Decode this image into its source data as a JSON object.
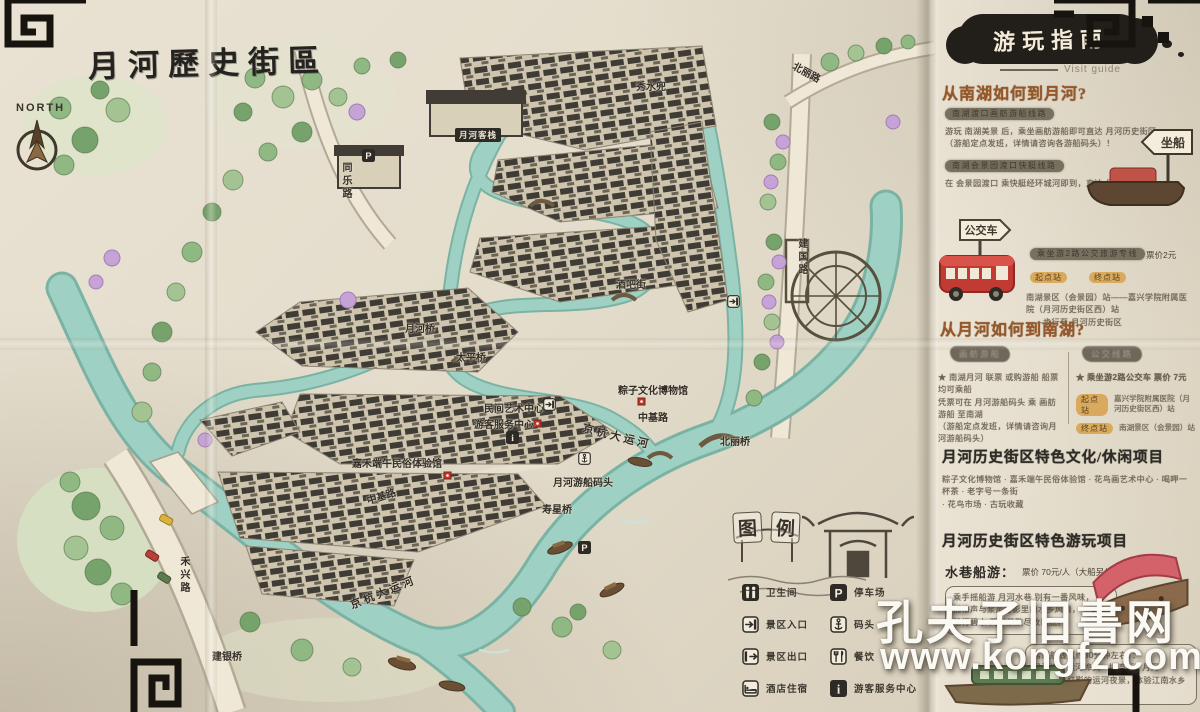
{
  "map": {
    "title": "月河歷史街區",
    "north_label": "NORTH",
    "labels": [
      {
        "text": "月河客栈",
        "x": 455,
        "y": 128,
        "cls": "sign"
      },
      {
        "text": "秀水兜",
        "x": 636,
        "y": 78
      },
      {
        "text": "北丽路",
        "x": 792,
        "y": 64,
        "r": 28
      },
      {
        "text": "同乐路",
        "x": 338,
        "y": 162,
        "v": 1
      },
      {
        "text": "建国路",
        "x": 794,
        "y": 238,
        "v": 1
      },
      {
        "text": "酒吧街",
        "x": 616,
        "y": 276
      },
      {
        "text": "月河桥",
        "x": 405,
        "y": 320
      },
      {
        "text": "太平桥",
        "x": 456,
        "y": 349
      },
      {
        "text": "粽子文化博物馆",
        "x": 618,
        "y": 382
      },
      {
        "text": "中基路",
        "x": 638,
        "y": 409
      },
      {
        "text": "民间艺术中心",
        "x": 484,
        "y": 400
      },
      {
        "text": "游客服务中心",
        "x": 474,
        "y": 416
      },
      {
        "text": "嘉禾端午民俗体验馆",
        "x": 352,
        "y": 455
      },
      {
        "text": "中基路",
        "x": 366,
        "y": 488,
        "r": -18
      },
      {
        "text": "月河游船码头",
        "x": 553,
        "y": 474
      },
      {
        "text": "京杭大运河",
        "x": 582,
        "y": 428,
        "r": 14,
        "cls": "big"
      },
      {
        "text": "北丽桥",
        "x": 720,
        "y": 433
      },
      {
        "text": "寿星桥",
        "x": 542,
        "y": 501
      },
      {
        "text": "京杭大运河",
        "x": 348,
        "y": 584,
        "r": -22,
        "cls": "big"
      },
      {
        "text": "禾兴路",
        "x": 176,
        "y": 556,
        "v": 1
      },
      {
        "text": "建银桥",
        "x": 212,
        "y": 648
      }
    ],
    "markers": [
      {
        "icon": "parking",
        "x": 362,
        "y": 149
      },
      {
        "icon": "parking",
        "x": 578,
        "y": 541
      },
      {
        "icon": "info",
        "x": 506,
        "y": 431
      },
      {
        "icon": "anchor",
        "x": 578,
        "y": 452
      },
      {
        "icon": "entrance",
        "x": 727,
        "y": 295
      },
      {
        "icon": "entrance",
        "x": 543,
        "y": 398
      }
    ]
  },
  "legend": {
    "title": "图例",
    "left": [
      {
        "icon": "toilet",
        "label": "卫生间"
      },
      {
        "icon": "entrance",
        "label": "景区入口"
      },
      {
        "icon": "exit",
        "label": "景区出口"
      },
      {
        "icon": "hotel",
        "label": "酒店住宿"
      }
    ],
    "right": [
      {
        "icon": "parking",
        "label": "停车场"
      },
      {
        "icon": "anchor",
        "label": "码头"
      },
      {
        "icon": "dining",
        "label": "餐饮"
      },
      {
        "icon": "info",
        "label": "游客服务中心"
      }
    ]
  },
  "guide": {
    "title": "游玩指南",
    "subtitle": "Visit guide",
    "s1": {
      "title": "从南湖如何到月河?",
      "bar1": "南湖渡口画舫游船线路",
      "p1": [
        "游玩 南湖美景 后，乘坐画舫游船即可直达 月河历史街区",
        "（游船定点发班，详情请咨询各游船码头）！"
      ],
      "bar2": "南湖会景园渡口快艇线路",
      "p2": [
        "在 会景园渡口 乘快艇经环城河即到，直达 月河历史街区"
      ],
      "boat_sign": "坐船"
    },
    "bus": {
      "sign": "公交车",
      "line": "乘坐游2路公交旅游专线",
      "price": "票价2元",
      "start_tag": "起点站",
      "end_tag": "终点站",
      "p": [
        "南湖景区（会景园）站——嘉兴学院附属医院（月河历史街区西）站",
        "——步行至 月河历史街区"
      ]
    },
    "s2": {
      "title": "从月河如何到南湖?",
      "col1_head": "画舫游船",
      "col2_head": "公交线路",
      "col1": [
        "★ 南湖月河 联票 或购游船 船票 均可乘船",
        "凭票可在 月河游船码头 乘 画舫游船 至南湖",
        "（游船定点发班，详情请咨询月河游船码头）"
      ],
      "col2_star": "★ 乘坐游2路公交车  票价 7元",
      "col2_rows": [
        {
          "tag": "起点站",
          "text": "嘉兴学院附属医院（月河历史街区西）站"
        },
        {
          "tag": "终点站",
          "text": "南湖景区（会景园）站"
        }
      ]
    },
    "s3": {
      "title": "月河历史街区特色文化/休闲项目",
      "p": [
        "粽子文化博物馆 · 嘉禾端午民俗体验馆 · 花鸟画艺术中心 · 喝呷一杯茶 · 老字号一条街",
        "· 花鸟市场 · 古玩收藏"
      ]
    },
    "s4": {
      "title": "月河历史街区特色游玩项目",
      "item": "水巷船游：",
      "price": "票价 70元/人（大船另价）",
      "bubble": [
        "乘手摇船游 月河水巷 别有一番风味，",
        "摇橹声与浆声灯影里的水乡风情，",
        "船行碧水 两岸景致尽收眼底。"
      ],
      "box2": [
        "常规航线（约30分钟左右）：",
        "月河湾 · 运河埠头 · 梅湾街 · 月河",
        "乘着夜色灯影的运河夜景，体验江南水乡的别样风情。"
      ]
    }
  },
  "watermark": {
    "line1": "孔夫子旧書网",
    "line2": "www.kongfz.com"
  },
  "colors": {
    "water": "#9ed1c3",
    "ink": "#2e2b26",
    "highlight": "#d9a95e",
    "bus_red": "#c23b33"
  }
}
